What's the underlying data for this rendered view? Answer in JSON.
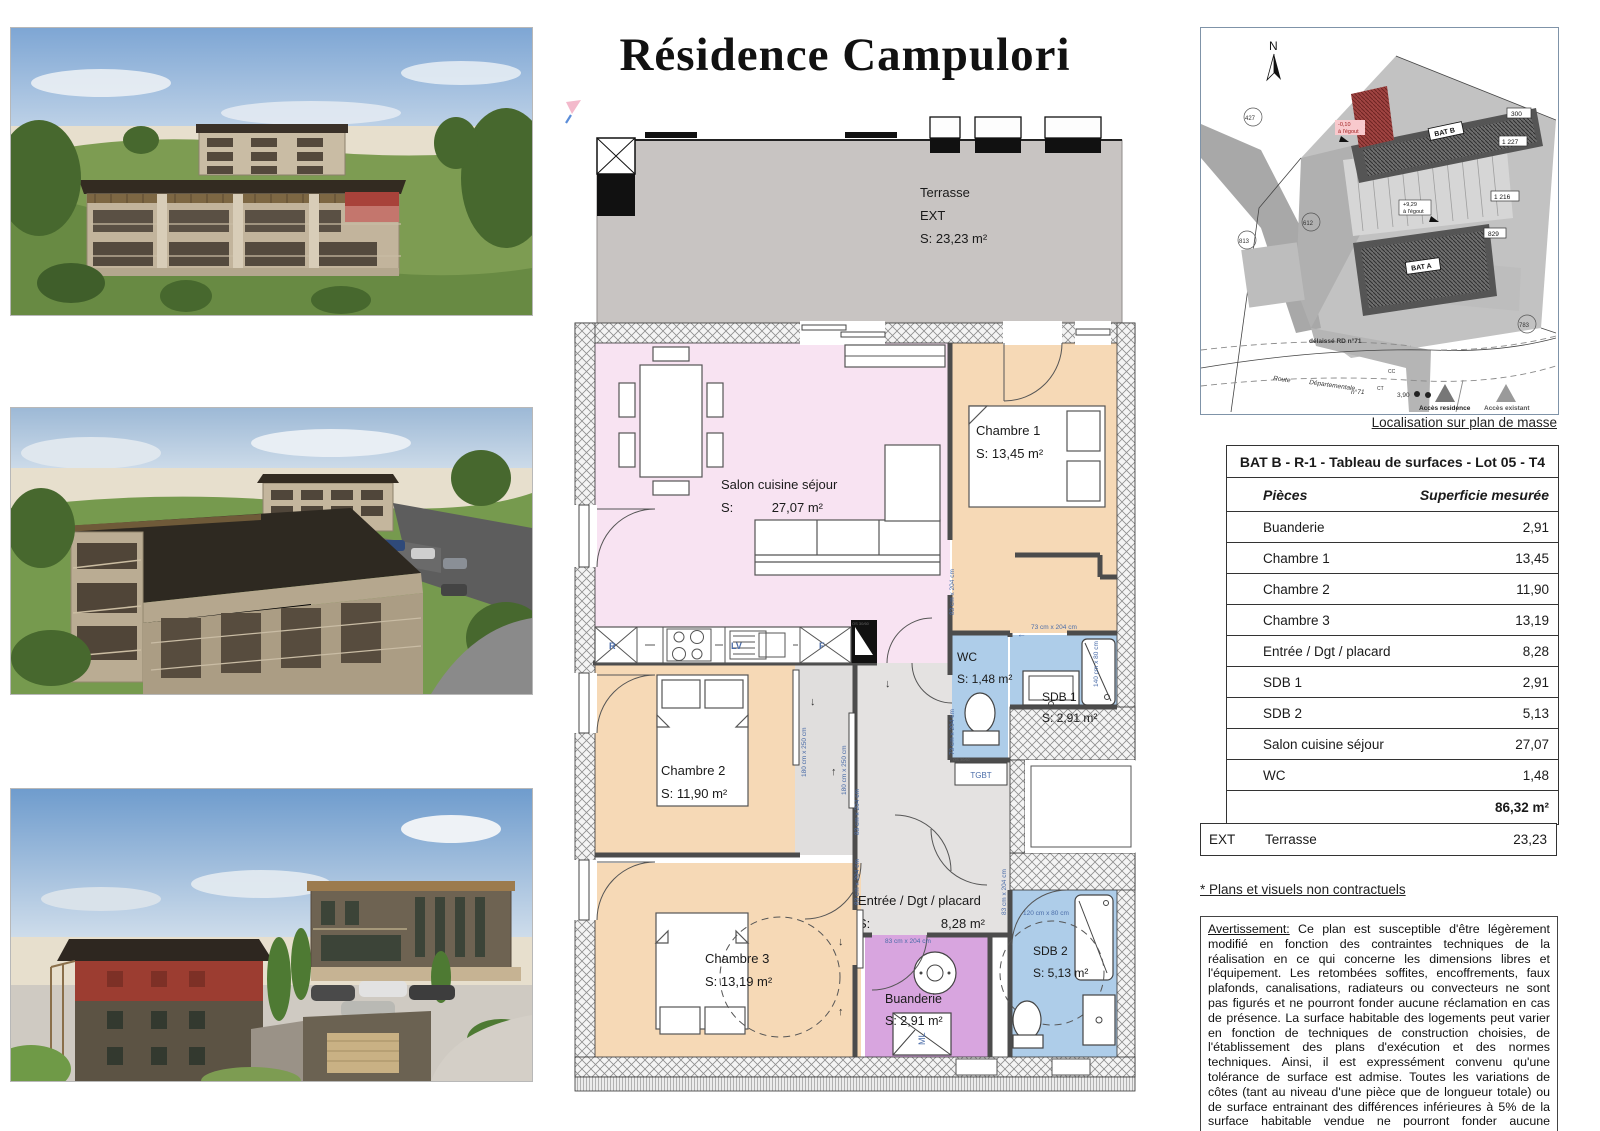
{
  "title": "Résidence Campulori",
  "map": {
    "caption": "Localisation sur plan de masse",
    "north": "N",
    "bat_b": "BAT B",
    "bat_a": "BAT A",
    "lot_level": "-0,10",
    "lot_level2": "à l'égout",
    "bata_level": "+9,29",
    "bata_level2": "à l'égout",
    "p427": "427",
    "p612": "612",
    "p813": "813",
    "p783": "783",
    "n300": "300",
    "n1227": "1 227",
    "n1216": "1 216",
    "n829": "829",
    "delaisse": "délaissé RD n°71",
    "route1": "Route",
    "route2": "Départementale",
    "route3": "n°71",
    "dim390": "3,90",
    "cc": "CC",
    "ct": "CT",
    "acces_res": "Accès residence",
    "acces_exi": "Accès existant"
  },
  "table": {
    "title": "BAT B - R-1 - Tableau de surfaces - Lot 05 - T4",
    "col_piece": "Pièces",
    "col_surface": "Superficie mesurée",
    "rows": [
      {
        "label": "Buanderie",
        "value": "2,91"
      },
      {
        "label": "Chambre 1",
        "value": "13,45"
      },
      {
        "label": "Chambre 2",
        "value": "11,90"
      },
      {
        "label": "Chambre 3",
        "value": "13,19"
      },
      {
        "label": "Entrée / Dgt  / placard",
        "value": "8,28"
      },
      {
        "label": "SDB 1",
        "value": "2,91"
      },
      {
        "label": "SDB 2",
        "value": "5,13"
      },
      {
        "label": "Salon cuisine séjour",
        "value": "27,07"
      },
      {
        "label": "WC",
        "value": "1,48"
      }
    ],
    "total": "86,32 m²",
    "ext_tag": "EXT",
    "ext_label": "Terrasse",
    "ext_value": "23,23"
  },
  "notes": {
    "non_contractual": "* Plans et visuels non contractuels",
    "warning_lead": "Avertissement:",
    "warning_body": " Ce plan est susceptible d'être légèrement modifié en fonction des contraintes techniques de la réalisation en ce qui concerne les dimensions libres et l'équipement. Les retombées soffites, encoffrements, faux plafonds, canalisations, radiateurs ou convecteurs ne sont pas figurés et ne pourront fonder aucune réclamation en cas de présence. La surface habitable des logements peut varier en fonction de techniques de construction choisies, de l'établissement des plans d'exécution et des normes techniques. Ainsi, il est expressément convenu qu'une tolérance de surface est admise. Toutes les variations de côtes (tant au niveau d'une pièce que de longueur totale) ou de surface entrainant des différences inférieures à 5% de la surface habitable vendue ne pourront fonder aucune réclamation."
  },
  "plan": {
    "terrasse": {
      "name": "Terrasse",
      "tag": "EXT",
      "area": "S: 23,23 m²"
    },
    "salon": {
      "name": "Salon cuisine séjour",
      "s": "S:",
      "area": "27,07 m²"
    },
    "chambre1": {
      "name": "Chambre 1",
      "area": "S: 13,45 m²"
    },
    "chambre2": {
      "name": "Chambre 2",
      "area": "S: 11,90 m²"
    },
    "chambre3": {
      "name": "Chambre 3",
      "area": "S: 13,19 m²"
    },
    "wc": {
      "name": "WC",
      "area": "S: 1,48 m²"
    },
    "sdb1": {
      "name": "SDB 1",
      "area": "S: 2,91 m²"
    },
    "sdb2": {
      "name": "SDB 2",
      "area": "S: 5,13 m²"
    },
    "entree": {
      "name": "Entrée / Dgt / placard",
      "s": "S:",
      "area": "8,28 m²"
    },
    "buanderie": {
      "name": "Buanderie",
      "area": "S: 2,91 m²"
    },
    "labels": {
      "tgbt": "TGBT",
      "ml": "ML",
      "r": "R",
      "lv": "LV",
      "f": "F",
      "os": "OS 30/60"
    },
    "dims": {
      "d83": "83 cm x 204 cm",
      "d73": "73 cm x 204 cm",
      "d180": "180 cm x 250 cm",
      "shower": "140 cm x 80 cm",
      "bath": "120 cm x 80 cm"
    },
    "arrows": {
      "down": "↓",
      "up": "↑",
      "left": "←"
    }
  },
  "colors": {
    "salon": "#f8e3f2",
    "bedroom": "#f6d9b6",
    "bath": "#aecde9",
    "laundry": "#d8a5df",
    "hall": "#e4e2e1",
    "terrace": "#c8c4c2",
    "wall": "#4c4c4c",
    "dim_blue": "#4a6ca8",
    "lot_red": "#a04442"
  }
}
